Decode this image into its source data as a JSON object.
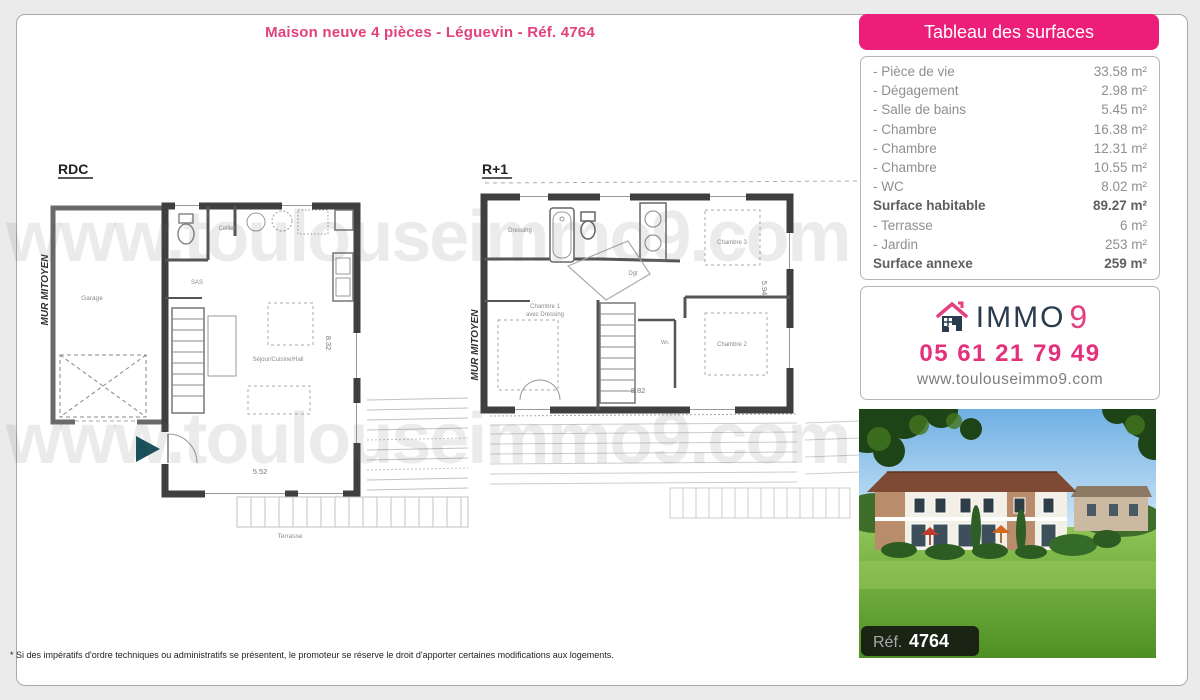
{
  "page": {
    "title": "Maison neuve 4 pièces - Léguevin - Réf. 4764",
    "watermark": "www.toulouseimmo9.com",
    "footnote": "* Si des impératifs d'ordre techniques ou administratifs se présentent, le promoteur se réserve le droit d'apporter certaines modifications aux logements."
  },
  "plans": {
    "rdc": {
      "label": "RDC",
      "party_wall": "MUR MITOYEN",
      "garage": "Garage",
      "sas": "SAS",
      "cellier": "Cellier",
      "living": "Séjour/Cuisine/Hall",
      "terrace": "Terrasse",
      "dim_width": "5.52",
      "dim_height": "8.32"
    },
    "r1": {
      "label": "R+1",
      "party_wall": "MUR MITOYEN",
      "dressing": "Dressing",
      "bedroom1_line1": "Chambre 1",
      "bedroom1_line2": "avec Dressing",
      "bedroom2": "Chambre 2",
      "bedroom3": "Chambre 3",
      "wc": "Wc",
      "hall": "Dgt",
      "dim_width": "8.82",
      "dim_height": "5.94"
    }
  },
  "surfaces": {
    "header": "Tableau des surfaces",
    "rows": [
      {
        "label": "- Pièce de vie",
        "value": "33.58 m²"
      },
      {
        "label": "- Dégagement",
        "value": "2.98 m²"
      },
      {
        "label": "- Salle de bains",
        "value": "5.45 m²"
      },
      {
        "label": "- Chambre",
        "value": "16.38 m²"
      },
      {
        "label": "- Chambre",
        "value": "12.31 m²"
      },
      {
        "label": "- Chambre",
        "value": "10.55 m²"
      },
      {
        "label": "- WC",
        "value": "8.02 m²"
      },
      {
        "label": "Surface habitable",
        "value": "89.27 m²"
      },
      {
        "label": "- Terrasse",
        "value": "6 m²"
      },
      {
        "label": "- Jardin",
        "value": "253 m²"
      },
      {
        "label": "Surface annexe",
        "value": "259 m²"
      }
    ]
  },
  "contact": {
    "brand": "IMMO",
    "brand_digit": "9",
    "phone": "05 61 21 79 49",
    "website": "www.toulouseimmo9.com"
  },
  "photo": {
    "ref_label": "Réf.",
    "ref_value": "4764"
  },
  "colors": {
    "accent_pink": "#ed1e79",
    "title_pink": "#e2417d",
    "brand_navy": "#2a3b4d",
    "entry_arrow_teal": "#17505c"
  }
}
